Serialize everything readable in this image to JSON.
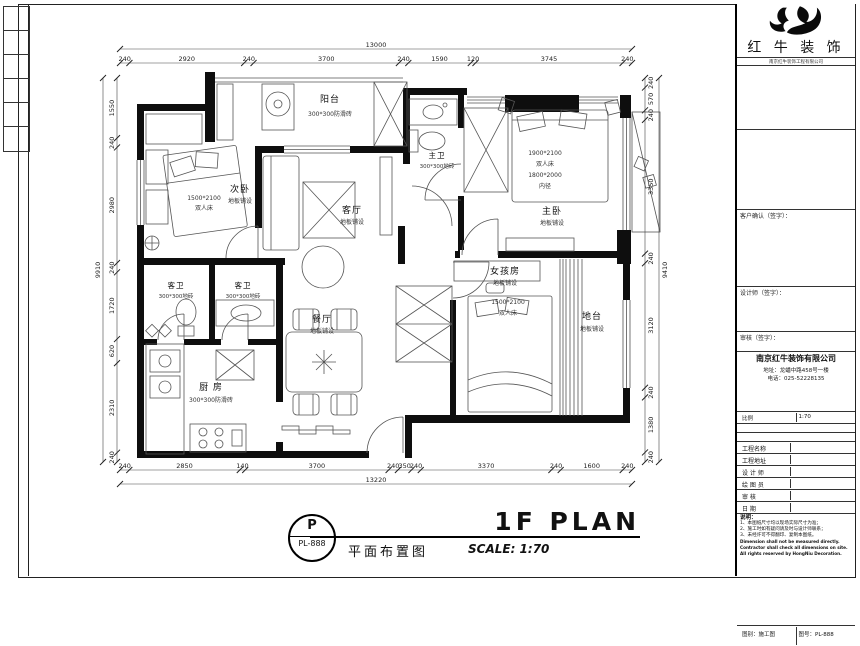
{
  "brand": {
    "name": "红 牛 装 饰",
    "tagline": "南京红牛装饰工程有限公司"
  },
  "title_block": {
    "customer_sign_label": "客户确认（签字）：",
    "designer_sign_label": "设计师（签字）：",
    "approve_sign_label": "审核（签字）：",
    "company": {
      "name": "南京红牛装饰有限公司",
      "address": "地址：龙蟠中路458号一楼",
      "phone": "电话：025-52228135"
    },
    "pair_left": "比例",
    "pair_right": "1:70",
    "rows": [
      {
        "label": "工程名称",
        "value": ""
      },
      {
        "label": "工程地址",
        "value": ""
      },
      {
        "label": "设 计 师",
        "value": ""
      },
      {
        "label": "绘 图 员",
        "value": ""
      },
      {
        "label": "审    核",
        "value": ""
      },
      {
        "label": "日    期",
        "value": ""
      }
    ],
    "notes_title": "说明：",
    "notes": [
      "1、本图纸尺寸均以现场实际尺寸为准；",
      "2、施工时如有疑问请及时与设计师联系；",
      "3、未经许可不得翻印、复制本图纸。"
    ],
    "notes_en": [
      "Dimension shall not be measured directly.",
      "Contractor shall check all dimensions on site.",
      "All rights reserved by HongNiu Decoration."
    ],
    "footer_left": "图别：施工图",
    "footer_right": "图号：PL-888"
  },
  "sheet_title": {
    "badge_letter": "P",
    "badge_code": "PL-888",
    "title_en": "1F PLAN",
    "title_cn": "平面布置图",
    "scale": "SCALE: 1:70"
  },
  "rooms": {
    "balcony": {
      "name": "阳台",
      "note": "300*300防滑砖"
    },
    "second_bedroom": {
      "name": "次卧",
      "note": "地板铺设",
      "bed_size": "1500*2100",
      "bed_type": "双人床"
    },
    "living": {
      "name": "客厅",
      "note": "地板铺设"
    },
    "master_bath": {
      "name": "主卫",
      "note": "300*300地砖"
    },
    "master_bedroom": {
      "name": "主卧",
      "note": "地板铺设",
      "bed_size": "1900*2100",
      "bed_type": "双人床",
      "bed_inner": "1800*2000",
      "bed_inner2": "内径"
    },
    "girl_room": {
      "name": "女孩房",
      "note": "地板铺设",
      "bed_size": "1500*2100",
      "bed_type": "双人床"
    },
    "platform": {
      "name": "地台",
      "note": "地板铺设"
    },
    "dining": {
      "name": "餐厅",
      "note": "地板铺设"
    },
    "kitchen": {
      "name": "厨 房",
      "note": "300*300防滑砖"
    },
    "guest_bath_1": {
      "name": "客卫",
      "note": "300*300地砖"
    },
    "guest_bath_2": {
      "name": "客卫",
      "note": "300*300地砖"
    }
  },
  "dimensions": {
    "top": {
      "total": "13000",
      "chain": [
        "240",
        "2920",
        "240",
        "3700",
        "240",
        "1590",
        "120",
        "3745",
        "240"
      ]
    },
    "bottom": {
      "total": "13220",
      "chain": [
        "240",
        "2850",
        "140",
        "3700",
        "240",
        "350",
        "240",
        "3370",
        "240",
        "1600",
        "240"
      ]
    },
    "left": {
      "total": "9910",
      "chain": [
        "1550",
        "240",
        "2980",
        "240",
        "1720",
        "620",
        "2310",
        "240"
      ]
    },
    "right": {
      "total": "9410",
      "chain": [
        "240",
        "570",
        "240",
        "3350",
        "240",
        "3120",
        "240",
        "1380",
        "240"
      ]
    }
  },
  "colors": {
    "wall": "#0e0e0e",
    "line": "#555555",
    "ink": "#000000"
  }
}
